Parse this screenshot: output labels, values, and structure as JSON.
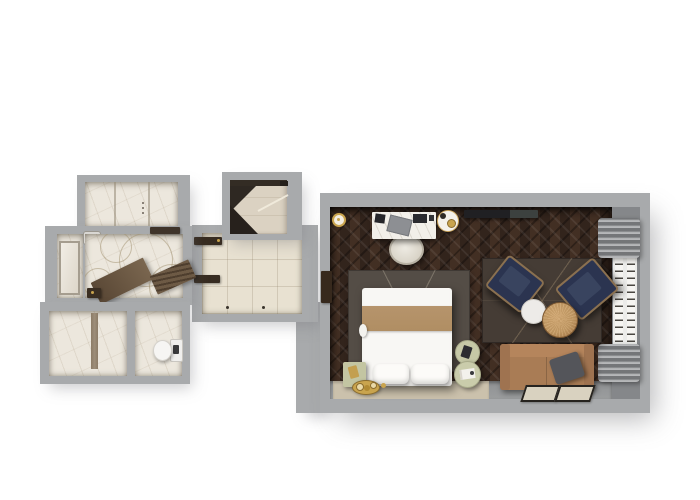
{
  "scene": {
    "type": "floor-plan-top-down-3d-render",
    "rooms": [
      {
        "name": "wet-room-top-left",
        "floor": "white-marble"
      },
      {
        "name": "master-bathroom",
        "floor": "white-marble-with-circle-motif"
      },
      {
        "name": "vanity-nook",
        "fixtures": [
          "mirror",
          "sink"
        ]
      },
      {
        "name": "shower-room",
        "fixtures": [
          "shower-fixture-strip"
        ]
      },
      {
        "name": "wc",
        "fixtures": [
          "toilet"
        ]
      },
      {
        "name": "closet-nook",
        "fixtures": [
          "closet-rail",
          "open-closet-doors"
        ]
      },
      {
        "name": "entry-hall",
        "fixtures": [
          "door-leaf",
          "door-leaf"
        ]
      },
      {
        "name": "bedroom-living-room",
        "floor": "dark-herringbone-wood"
      }
    ],
    "furniture": [
      "desk-with-marble-top",
      "desk-chair",
      "laptop",
      "document-folder",
      "coffee-tray-with-cups",
      "wall-mounted-tv",
      "ceiling-light-ring",
      "bed-with-tan-runner",
      "pillow",
      "pillow",
      "bed-area-rug",
      "bed-platform",
      "sage-nightstand-cabinet",
      "gold-decor-tray",
      "round-side-table",
      "round-side-table",
      "sitting-area-rug",
      "navy-armchair",
      "navy-armchair",
      "white-side-table",
      "round-wood-coffee-table",
      "tan-sofa",
      "gray-throw-pillow",
      "floor-mat",
      "floor-mat",
      "window-with-panes",
      "gray-curtains",
      "bath-mat-ramp",
      "bath-mat-slatted"
    ]
  },
  "palette": {
    "wall": "#a8aaac",
    "marble": "#ece7dd",
    "entry_floor": "#e8e1d1",
    "closet_floor": "#dbd2c2",
    "wood_floor": "#38281f",
    "bed_rug": "#544d46",
    "sitting_rug": "#453c35",
    "runner": "#b08e63",
    "linen": "#f8f7f4",
    "platform": "#cbc1ac",
    "stone_strip": "#96989a",
    "sage": "#c3c5a2",
    "gold": "#c9a44e",
    "navy": "#2b3450",
    "sofa": "#a97c55",
    "wood_table": "#c79d66",
    "white_table": "#edebe8",
    "curtain": "#8f9193",
    "door": "#372c21",
    "window_frame": "#ececea",
    "tv": "#202023"
  }
}
